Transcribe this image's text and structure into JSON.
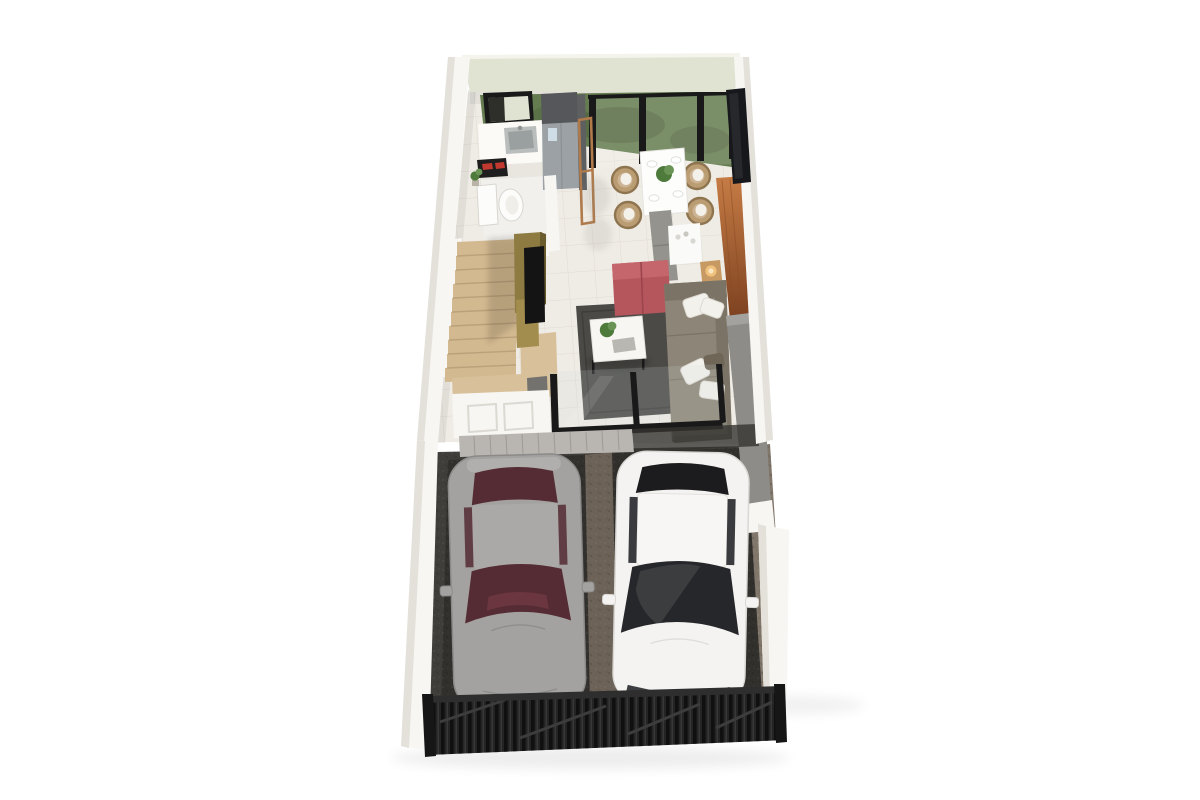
{
  "scene": {
    "type": "3d-floor-plan-render",
    "view": "top-down perspective, no text labels",
    "rooms": [
      {
        "name": "kitchen",
        "items": [
          "counter",
          "sink",
          "cooktop",
          "refrigerator",
          "open-window",
          "shelf-frame"
        ]
      },
      {
        "name": "bathroom",
        "items": [
          "toilet",
          "potted-plant"
        ]
      },
      {
        "name": "staircase",
        "items": [
          "wood-treads",
          "olive-partition",
          "tv-panel",
          "wood-cabinet"
        ]
      },
      {
        "name": "dining-area",
        "items": [
          "white-table",
          "wicker-chairs",
          "gray-bench",
          "centerpiece-plant",
          "plates",
          "glass-balustrade",
          "garden-grass"
        ]
      },
      {
        "name": "living-room",
        "items": [
          "taupe-sofa",
          "white-pillows",
          "red-ottoman",
          "gray-rug",
          "coffee-table",
          "plant",
          "book",
          "console-shelf",
          "side-table",
          "lamp",
          "wood-accent-wall",
          "glass-sliding-doors"
        ]
      },
      {
        "name": "entry",
        "items": [
          "paneled-wall",
          "cabinet",
          "threshold-tiles"
        ]
      },
      {
        "name": "driveway-garage",
        "items": [
          "gray-car",
          "white-car",
          "concrete-strip",
          "gravel-border",
          "metal-fence-gate"
        ]
      }
    ],
    "vehicle_count": 2
  },
  "colors": {
    "background": "#ffffff",
    "wall_white": "#f7f6f3",
    "wall_shade": "#e4e1da",
    "back_wall": "#e0e3d2",
    "back_wall_rim": "#f4f4ec",
    "floor_tile": "#efece5",
    "hall_floor": "#f5f4f1",
    "grass": "#657c50",
    "grass_dark": "#50633d",
    "frame_black": "#191919",
    "dark_window": "#17181c",
    "window_pane": "#2e2f2a",
    "counter": "#fbfaf7",
    "sink_steel": "#b9bdbc",
    "sink_inner": "#9aa09f",
    "cooktop_black": "#1e1e1e",
    "cooktop_red": "#c23a2f",
    "fridge_top": "#55575a",
    "fridge_steel": "#9ba1a5",
    "fridge_side": "#5d5f61",
    "dispenser": "#cfdde6",
    "wood_frame": "#b07a4a",
    "toilet_white": "#fcfcfb",
    "fixture_stroke": "#d9d6d1",
    "plant_green": "#4e7a3b",
    "plant_green_light": "#6a9455",
    "wood_stair": "#d3b990",
    "stair_line": "#b59a74",
    "olive": "#8d7b41",
    "olive_dark": "#6b5c30",
    "gold_panel": "#a38d4e",
    "tv_black": "#141414",
    "wood_cabinet": "#d8c19a",
    "table_white": "#fdfdfc",
    "chair_wicker": "#bb9d74",
    "chair_wicker_dark": "#8f7450",
    "chair_inner": "#cdb494",
    "bench_gray": "#95938e",
    "console_white": "#fafaf8",
    "side_table_wood": "#c69a62",
    "lamp_glow": "#efc17c",
    "ottoman_red": "#b5565c",
    "ottoman_red_dark": "#9c454c",
    "sofa_taupe": "#8d8577",
    "sofa_taupe_dark": "#7b7365",
    "pillow_white": "#f3f1ec",
    "pillow_taupe": "#6f6658",
    "rug_gray": "#4b4a47",
    "coffee_table": "#f7f6f3",
    "book_gray": "#b9b7b2",
    "wood_wall_light": "#c67c45",
    "wood_wall_dark": "#7c4120",
    "gray_wall": "#8d8c88",
    "threshold_tile": "#b9b5b0",
    "threshold_line": "#9e9a95",
    "garage_floor": "#403e3b",
    "garage_pad": "#2f2e2c",
    "garage_strip": "#6f6459",
    "gravel_tan": "#80766a",
    "car_gray_body": "#a3a2a0",
    "car_gray_shade": "#8b8a88",
    "car_gray_roof": "#aaa9a7",
    "car_gray_glass": "#552c34",
    "car_white_body": "#f4f3f1",
    "car_white_shade": "#d8d7d4",
    "car_white_glass": "#26272a",
    "fence_black": "#242424",
    "fence_dark": "#161616"
  }
}
